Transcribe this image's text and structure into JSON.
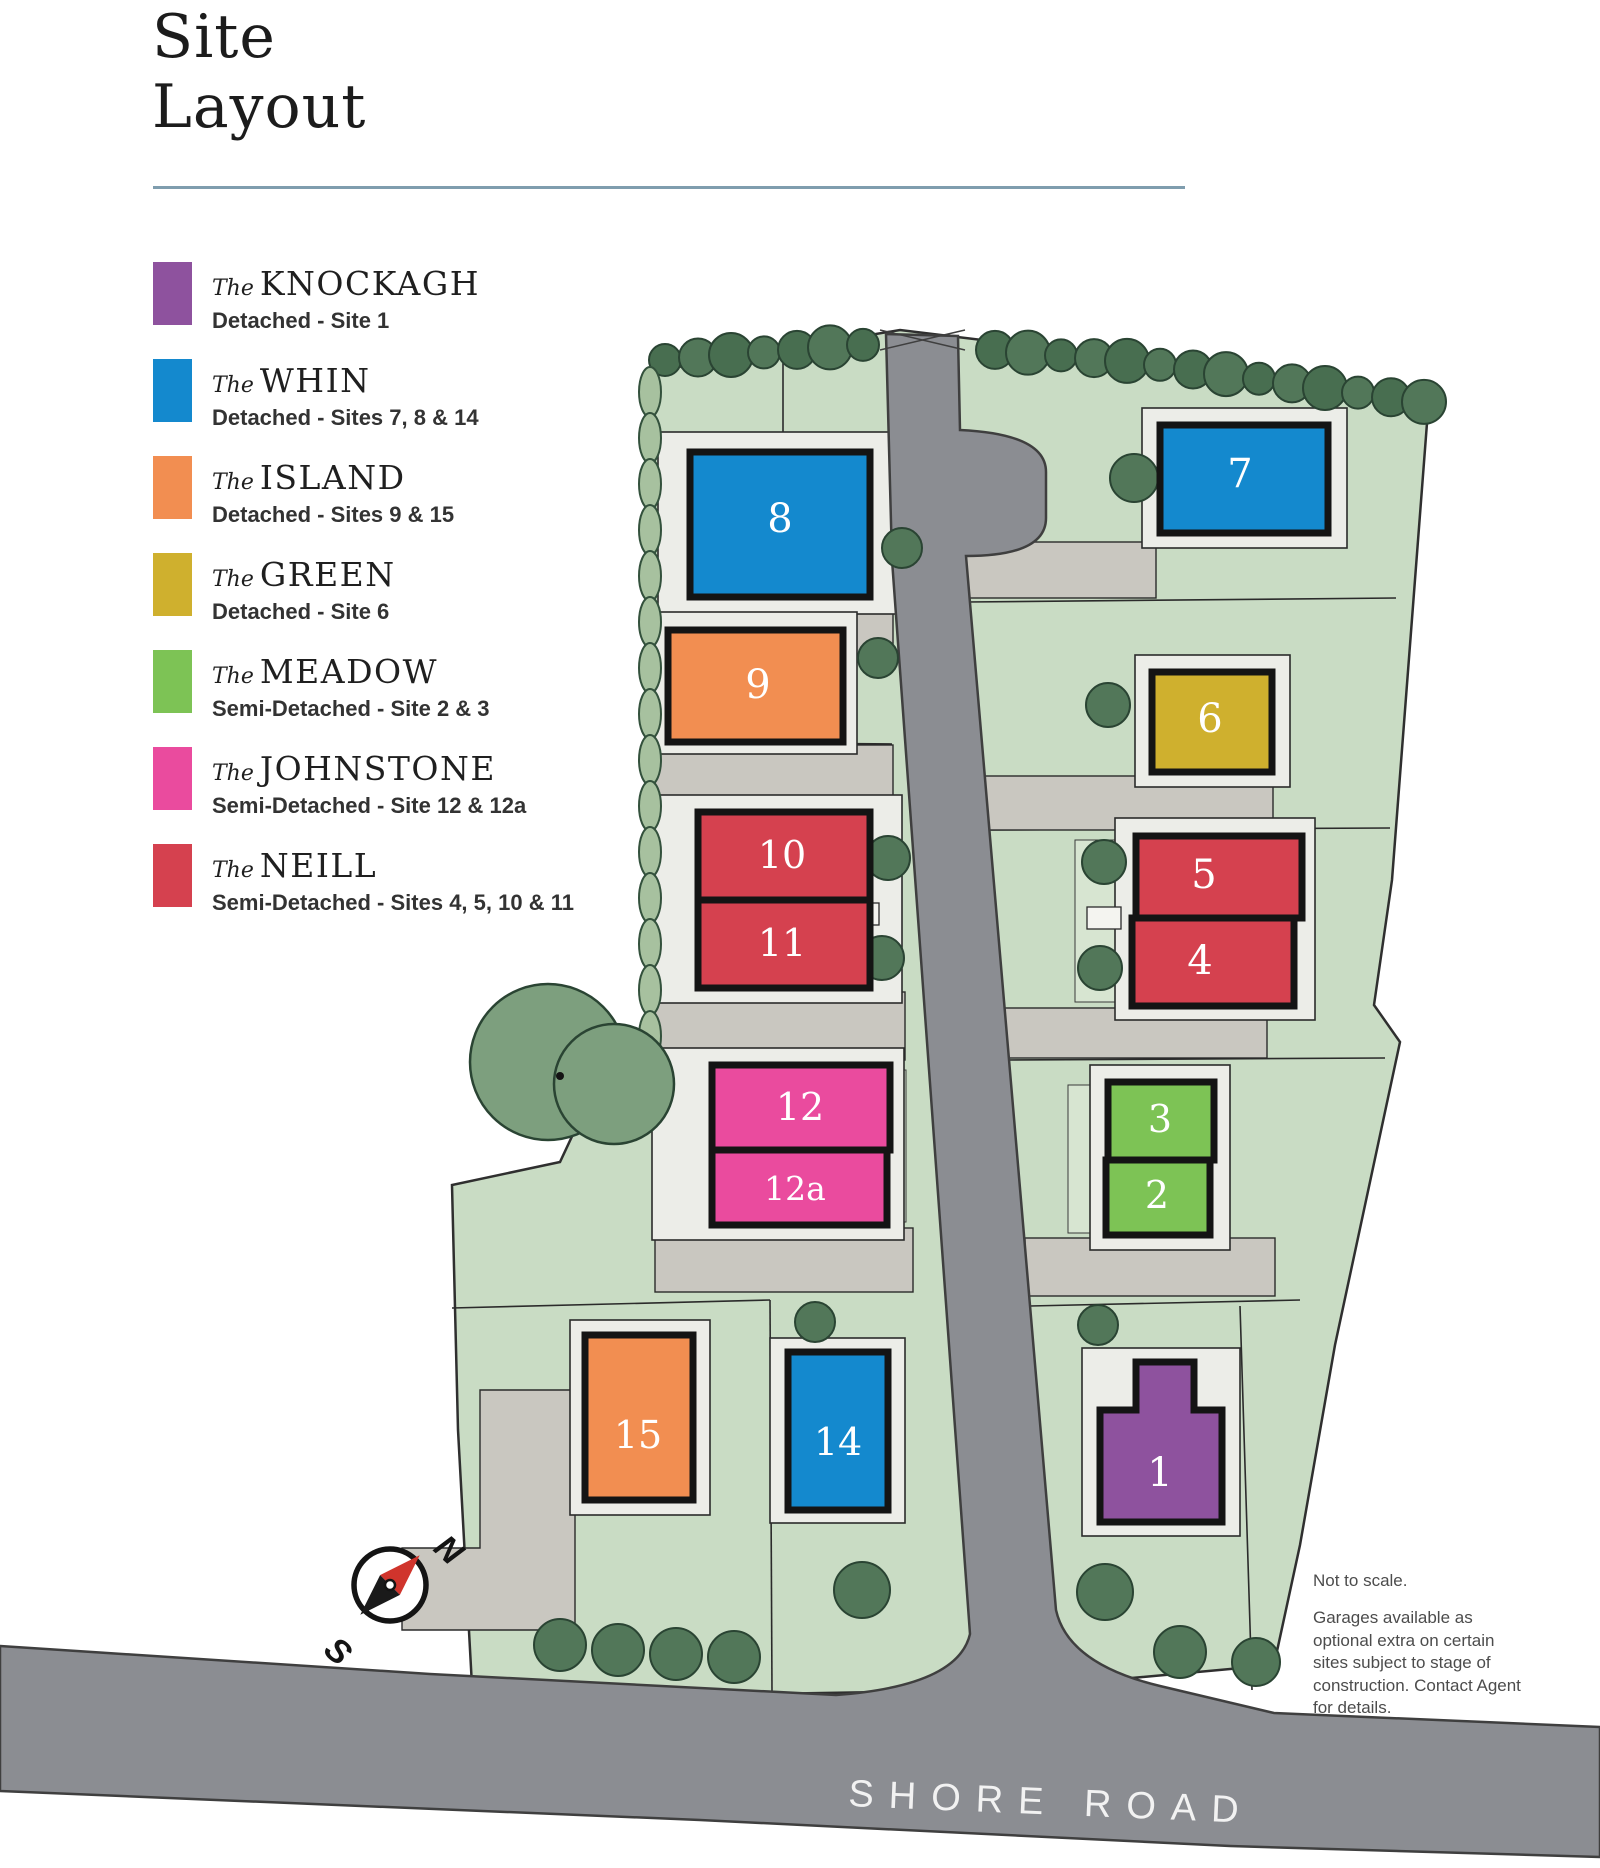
{
  "title": "Site Layout",
  "legend": {
    "items": [
      {
        "id": "knockagh",
        "prefix": "The",
        "name": "KNOCKAGH",
        "type_label": "Detached",
        "sites_label": "Site 1",
        "color": "#8e529e"
      },
      {
        "id": "whin",
        "prefix": "The",
        "name": "WHIN",
        "type_label": "Detached",
        "sites_label": "Sites 7, 8 & 14",
        "color": "#1489ce"
      },
      {
        "id": "island",
        "prefix": "The",
        "name": "ISLAND",
        "type_label": "Detached",
        "sites_label": "Sites 9 & 15",
        "color": "#f28e51"
      },
      {
        "id": "green",
        "prefix": "The",
        "name": "GREEN",
        "type_label": "Detached",
        "sites_label": "Site 6",
        "color": "#cfb02e"
      },
      {
        "id": "meadow",
        "prefix": "The",
        "name": "MEADOW",
        "type_label": "Semi-Detached",
        "sites_label": "Site 2 & 3",
        "color": "#7dc355"
      },
      {
        "id": "johnstone",
        "prefix": "The",
        "name": "JOHNSTONE",
        "type_label": "Semi-Detached",
        "sites_label": "Site 12 & 12a",
        "color": "#ea4b9e"
      },
      {
        "id": "neill",
        "prefix": "The",
        "name": "NEILL",
        "type_label": "Semi-Detached",
        "sites_label": "Sites 4, 5, 10 & 11",
        "color": "#d5414f"
      }
    ]
  },
  "map": {
    "houses": [
      {
        "site": "8",
        "type": "whin"
      },
      {
        "site": "7",
        "type": "whin"
      },
      {
        "site": "9",
        "type": "island"
      },
      {
        "site": "6",
        "type": "green"
      },
      {
        "site": "10",
        "type": "neill"
      },
      {
        "site": "11",
        "type": "neill"
      },
      {
        "site": "5",
        "type": "neill"
      },
      {
        "site": "4",
        "type": "neill"
      },
      {
        "site": "12",
        "type": "johnstone"
      },
      {
        "site": "12a",
        "type": "johnstone"
      },
      {
        "site": "3",
        "type": "meadow"
      },
      {
        "site": "2",
        "type": "meadow"
      },
      {
        "site": "15",
        "type": "island"
      },
      {
        "site": "14",
        "type": "whin"
      },
      {
        "site": "1",
        "type": "knockagh"
      }
    ],
    "road_label": "SHORE ROAD",
    "compass": {
      "north": "N",
      "south": "S"
    },
    "notes": {
      "line1": "Not to scale.",
      "paragraph": "Garages available as optional extra on certain sites subject to stage of construction. Contact Agent for details."
    }
  }
}
